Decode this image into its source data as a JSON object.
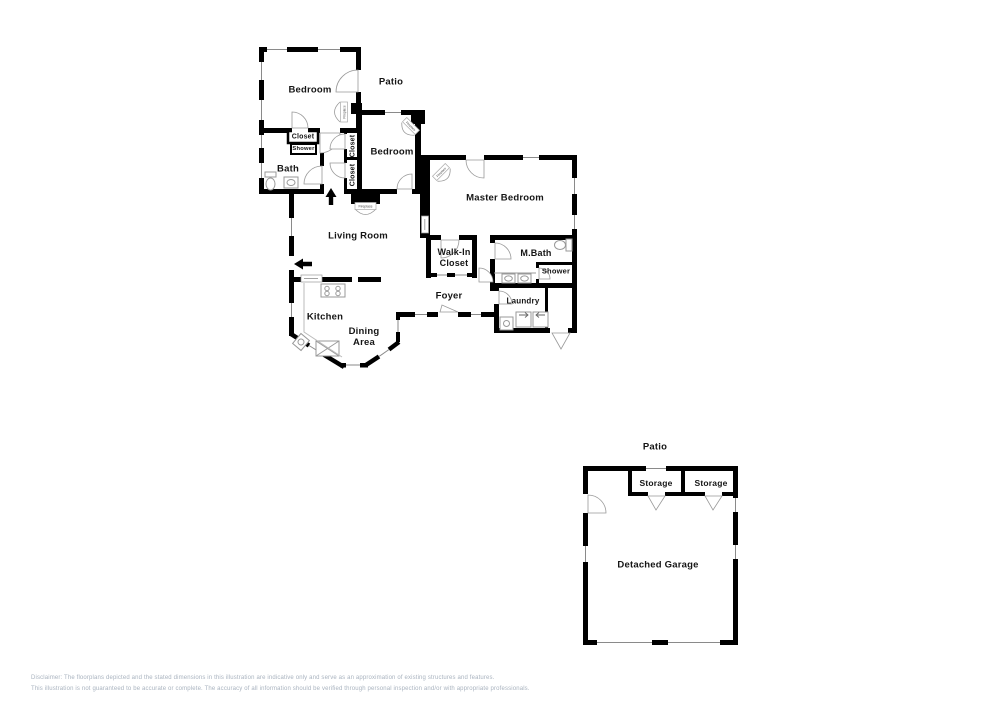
{
  "rooms": {
    "bedroom1": "Bedroom",
    "patio_house": "Patio",
    "closet_bath": "Closet",
    "shower_bath": "Shower",
    "bath": "Bath",
    "closet_hall_1": "Closet",
    "closet_hall_2": "Closet",
    "bedroom2": "Bedroom",
    "master_bedroom": "Master Bedroom",
    "living_room": "Living Room",
    "walk_in_line1": "Walk-In",
    "walk_in_line2": "Closet",
    "m_bath": "M.Bath",
    "shower_master": "Shower",
    "foyer": "Foyer",
    "laundry": "Laundry",
    "kitchen": "Kitchen",
    "dining_line1": "Dining",
    "dining_line2": "Area",
    "patio_garage": "Patio",
    "storage_1": "Storage",
    "storage_2": "Storage",
    "detached_garage": "Detached Garage"
  },
  "fixtures": {
    "fireplace": "Fireplace"
  },
  "disclaimer": {
    "line1": "Disclaimer: The floorplans depicted and the stated dimensions in this illustration are indicative only and serve as an approximation of existing structures and features.",
    "line2": "This illustration is not guaranteed to be accurate or complete. The accuracy of all information should be verified through personal inspection and/or with appropriate professionals."
  },
  "colors": {
    "wall": "#000000",
    "label_text": "#151515",
    "fixture_line": "#999999",
    "disclaimer_text": "#a9b3bf",
    "background": "#ffffff"
  }
}
